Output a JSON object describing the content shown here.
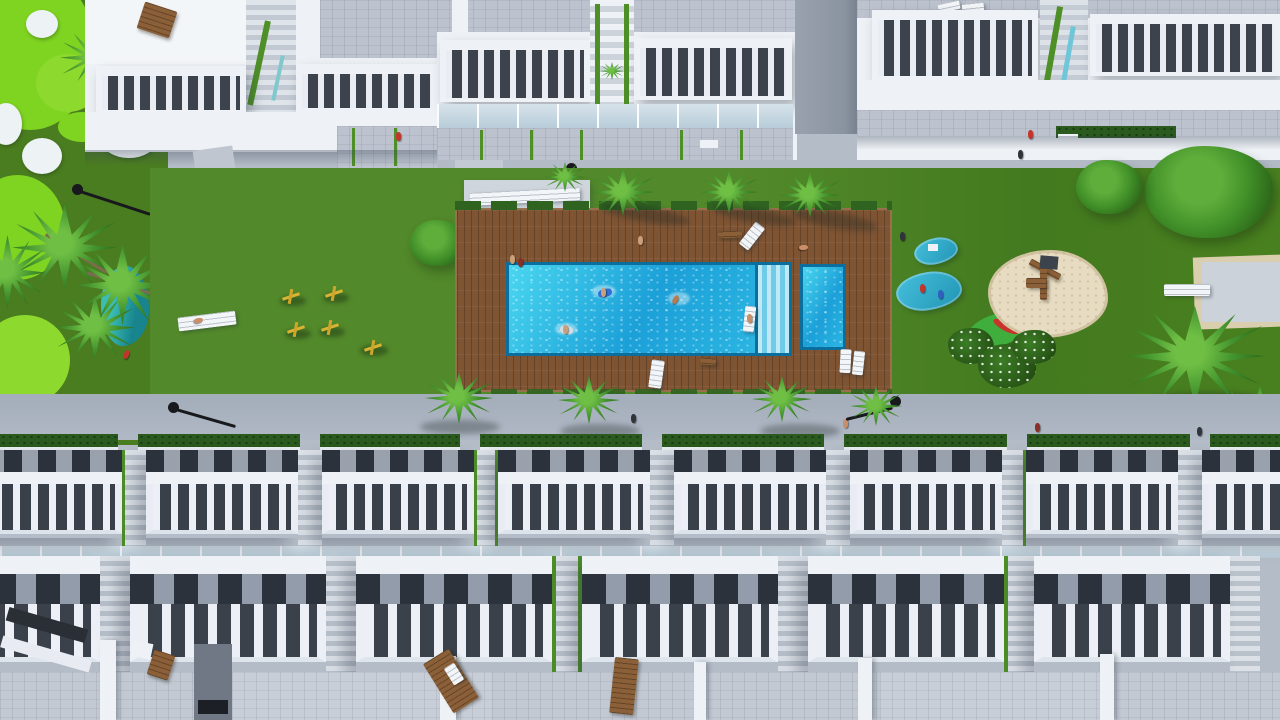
{
  "meta": {
    "title": "Aerial 3D architectural render of a residential complex with communal pool and gardens",
    "view": "top-down aerial",
    "render_type": "architectural visualization, no visible text"
  },
  "palette": {
    "walk": "#b4bcc7",
    "walk2": "#aab3bf",
    "white": "#eef2f6",
    "tile": "#bcc3ce",
    "slat": "#3c434d",
    "dark": "#2b323b",
    "lawn": "#4e8424",
    "golf": "#4a7c20",
    "bright": "#7fd321",
    "bunker": "#edf2f4",
    "deck": "#7e5433",
    "poolrim": "#0b6e9c",
    "hedge": "#2a5a1d",
    "rail": "#4e8f28",
    "sand": "#e7dcc2",
    "wood": "#8b6038",
    "lamp": "#17191d",
    "teal": "#1d8f96"
  },
  "scene": {
    "top_buildings": {
      "count": 5,
      "style": "white apartment blocks with slatted roof-terrace balustrades and tiled solariums",
      "stairwells_with_planters": 3
    },
    "bottom_townhouses": {
      "rows": 3,
      "style": "staggered white townhouses with slatted balustrade terraces and grey tiled roofs"
    },
    "pool": {
      "shape": "rectangular",
      "swimmers": 4,
      "corner_steps": true,
      "side_step_band": true,
      "kids_pool": true
    },
    "deck": {
      "material": "wooden planks",
      "sun_loungers": 7
    },
    "golf_green": {
      "bunkers": 4,
      "bright_patches": 5,
      "pond": true
    },
    "playground": {
      "sand_pit": true,
      "wooden_climbing_frame": true,
      "splash_mats": 3,
      "outdoor_gym_stations": 5
    },
    "petanque_court": true,
    "landscaping": {
      "palm_trees": 14,
      "round_trees": 3,
      "flowering_bushes": 3,
      "hedges": true
    },
    "walkways": {
      "street_lamps": 5,
      "pedestrians": 12
    }
  }
}
